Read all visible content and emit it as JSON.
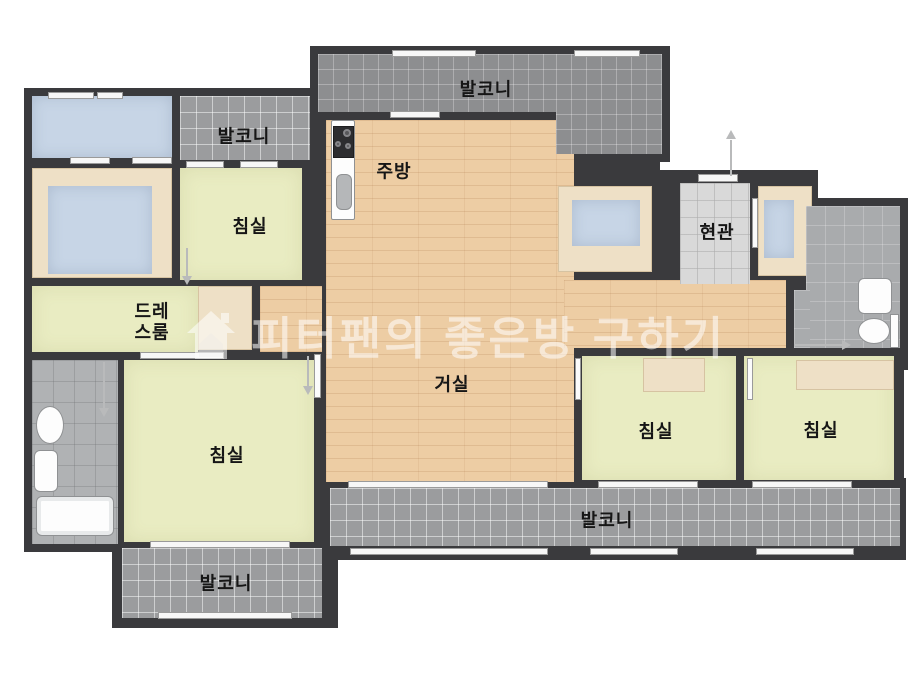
{
  "floorplan": {
    "title": "apartment-floor-plan",
    "watermark": {
      "text": "피터팬의 좋은방 구하기",
      "icon": "house-icon"
    },
    "rooms": {
      "balcony_top": {
        "label": "발코니"
      },
      "balcony_top_left": {
        "label": "발코니"
      },
      "balcony_bottom": {
        "label": "발코니"
      },
      "balcony_bottom_left": {
        "label": "발코니"
      },
      "kitchen": {
        "label": "주방"
      },
      "entrance": {
        "label": "현관"
      },
      "living_room": {
        "label": "거실"
      },
      "bedroom_top_left": {
        "label": "침실"
      },
      "bedroom_bottom_left": {
        "label": "침실"
      },
      "bedroom_right_1": {
        "label": "침실"
      },
      "bedroom_right_2": {
        "label": "침실"
      },
      "dress_room": {
        "label": "드레스룸",
        "line1": "드레",
        "line2": "스룸"
      }
    },
    "fixtures": [
      "stove",
      "kitchen-sink",
      "toilet",
      "wash-basin",
      "bathtub",
      "toilet-2",
      "wash-basin-2",
      "bed",
      "bed-2",
      "closet",
      "shoe-closet"
    ],
    "colors": {
      "wall": "#3a3a3d",
      "wood_floor": "#edcda4",
      "bedroom_floor": "#e9ecc2",
      "balcony_tile": "#8d8e90",
      "bath_tile": "#b0b2b4",
      "entrance_tile": "#d9d9d9",
      "closet_blue": "#c7d5e6",
      "furniture_beige": "#eee0c6",
      "watermark_white": "rgba(255,255,255,0.55)"
    }
  }
}
